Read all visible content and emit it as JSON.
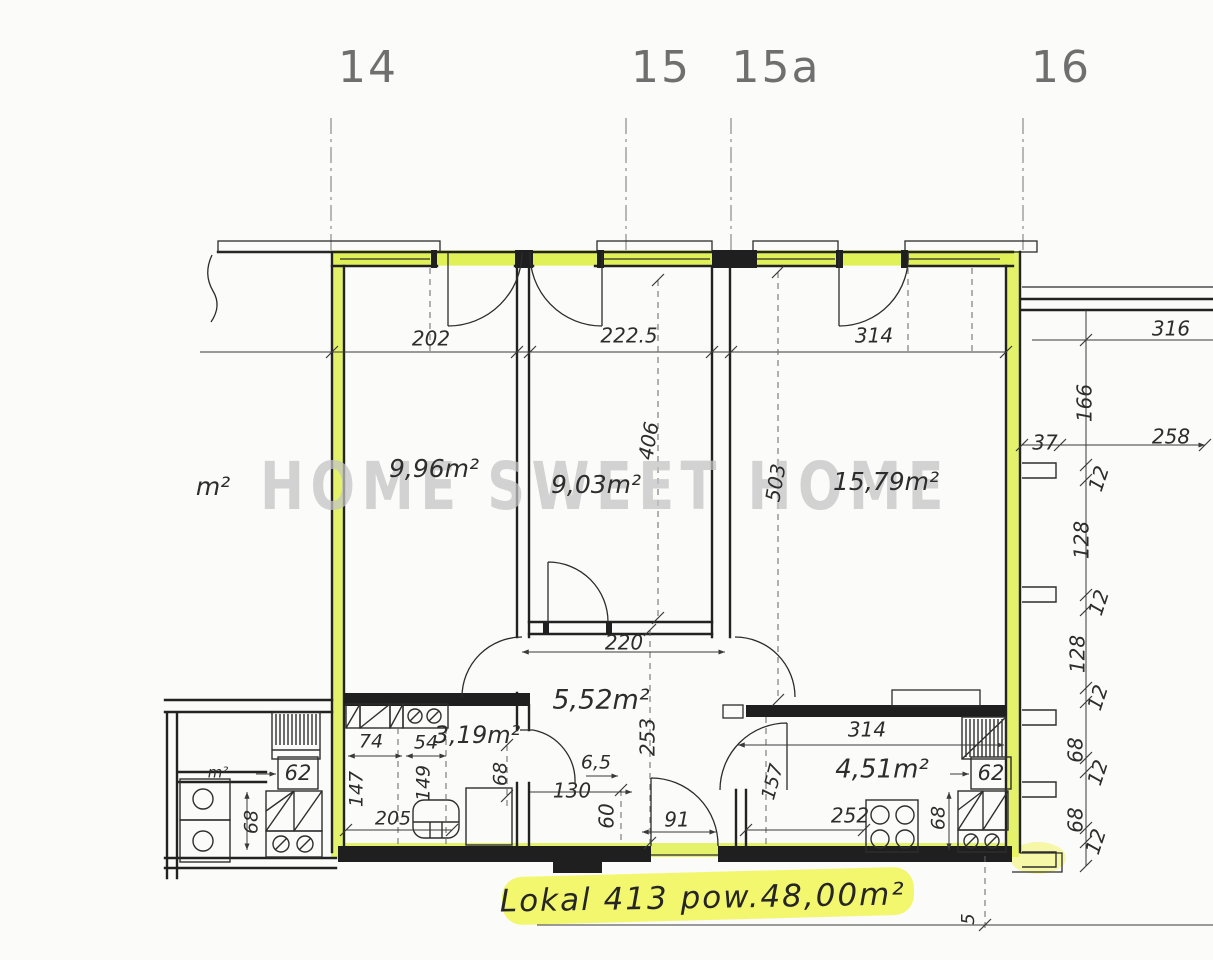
{
  "watermark": "HOME SWEET HOME",
  "caption": "Lokal 413   pow.48,00m²",
  "axis_labels": [
    {
      "text": "14",
      "x": 368
    },
    {
      "text": "15",
      "x": 661
    },
    {
      "text": "15a",
      "x": 776
    },
    {
      "text": "16",
      "x": 1061
    }
  ],
  "room_areas": [
    {
      "name": "room-1-area",
      "text": "9,96m²",
      "x": 434,
      "y": 470,
      "size": 25
    },
    {
      "name": "room-2-area",
      "text": "9,03m²",
      "x": 596,
      "y": 486,
      "size": 25
    },
    {
      "name": "room-3-area",
      "text": "15,79m²",
      "x": 886,
      "y": 483,
      "size": 25,
      "color": "#565656"
    },
    {
      "name": "hall-area",
      "text": "5,52m²",
      "x": 601,
      "y": 701,
      "size": 27
    },
    {
      "name": "bathroom-area",
      "text": "3,19m²",
      "x": 477,
      "y": 736,
      "size": 24
    },
    {
      "name": "kitchen-area",
      "text": "4,51m²",
      "x": 882,
      "y": 770,
      "size": 26
    },
    {
      "name": "neighbor-room-area-partial",
      "text": "m²",
      "x": 213,
      "y": 488,
      "size": 25
    },
    {
      "name": "neighbor-bath-area-partial",
      "text": "m²",
      "x": 218,
      "y": 773,
      "size": 15
    }
  ],
  "dimensions": [
    {
      "text": "202",
      "x": 431,
      "y": 340
    },
    {
      "text": "222.5",
      "x": 629,
      "y": 337
    },
    {
      "text": "314",
      "x": 874,
      "y": 337
    },
    {
      "text": "316",
      "x": 1171,
      "y": 330
    },
    {
      "text": "166",
      "x": 1086,
      "y": 403,
      "rot": -90
    },
    {
      "text": "37",
      "x": 1045,
      "y": 444
    },
    {
      "text": "258",
      "x": 1171,
      "y": 438
    },
    {
      "text": "12",
      "x": 1100,
      "y": 479,
      "rot": -72
    },
    {
      "text": "128",
      "x": 1083,
      "y": 540,
      "rot": -90
    },
    {
      "text": "12",
      "x": 1100,
      "y": 603,
      "rot": -72
    },
    {
      "text": "128",
      "x": 1079,
      "y": 654,
      "rot": -90
    },
    {
      "text": "12",
      "x": 1099,
      "y": 698,
      "rot": -72
    },
    {
      "text": "68",
      "x": 1077,
      "y": 750,
      "rot": -90
    },
    {
      "text": "12",
      "x": 1099,
      "y": 773,
      "rot": -72
    },
    {
      "text": "68",
      "x": 1077,
      "y": 820,
      "rot": -90
    },
    {
      "text": "12",
      "x": 1097,
      "y": 842,
      "rot": -72
    },
    {
      "text": "5",
      "x": 969,
      "y": 919,
      "rot": -90,
      "size": 18
    },
    {
      "text": "406",
      "x": 650,
      "y": 441,
      "rot": -80
    },
    {
      "text": "503",
      "x": 777,
      "y": 483,
      "rot": -80
    },
    {
      "text": "220",
      "x": 624,
      "y": 644
    },
    {
      "text": "253",
      "x": 649,
      "y": 737,
      "rot": -90
    },
    {
      "text": "6,5",
      "x": 596,
      "y": 763,
      "size": 19
    },
    {
      "text": "130",
      "x": 572,
      "y": 792
    },
    {
      "text": "60",
      "x": 608,
      "y": 816,
      "rot": -90
    },
    {
      "text": "91",
      "x": 677,
      "y": 821
    },
    {
      "text": "74",
      "x": 371,
      "y": 742,
      "size": 19
    },
    {
      "text": "54",
      "x": 426,
      "y": 743,
      "size": 19
    },
    {
      "text": "147",
      "x": 357,
      "y": 789,
      "rot": -90,
      "size": 19
    },
    {
      "text": "149",
      "x": 424,
      "y": 783,
      "rot": -90,
      "size": 19
    },
    {
      "text": "205",
      "x": 393,
      "y": 819,
      "size": 19
    },
    {
      "text": "68",
      "x": 501,
      "y": 774,
      "rot": -90,
      "size": 19
    },
    {
      "text": "68",
      "x": 252,
      "y": 822,
      "rot": -90,
      "size": 19
    },
    {
      "text": "314",
      "x": 867,
      "y": 731
    },
    {
      "text": "252",
      "x": 850,
      "y": 817
    },
    {
      "text": "157",
      "x": 773,
      "y": 782,
      "rot": -75,
      "size": 19
    },
    {
      "text": "68",
      "x": 939,
      "y": 818,
      "rot": -90,
      "size": 19
    }
  ],
  "boxed_dims": [
    {
      "name": "neighbor-radiator-dim",
      "text": "62",
      "x": 298,
      "y": 774
    },
    {
      "name": "kitchen-radiator-dim",
      "text": "62",
      "x": 991,
      "y": 774
    }
  ]
}
